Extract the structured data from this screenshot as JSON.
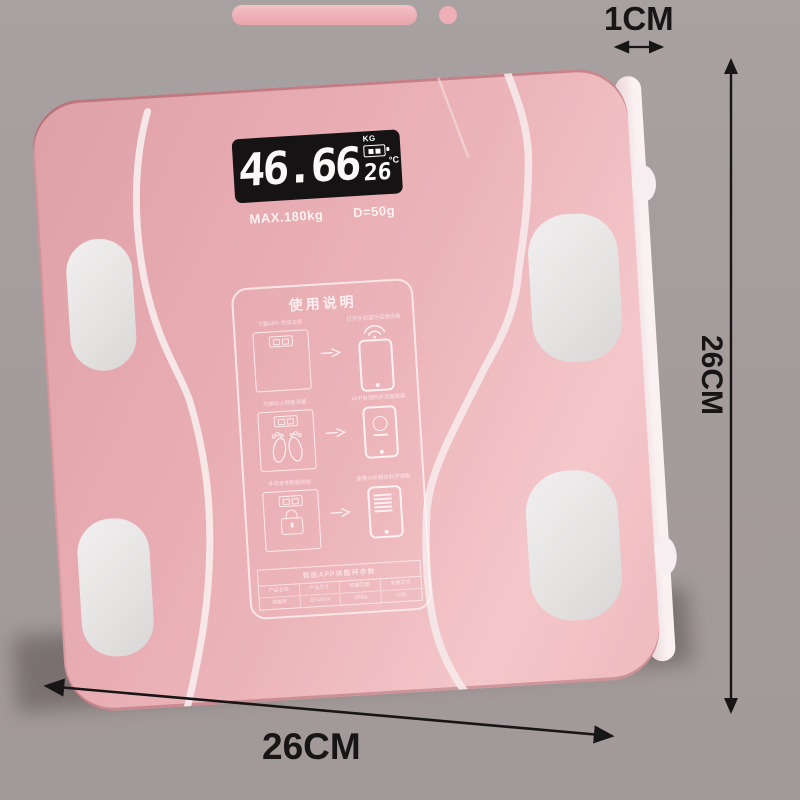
{
  "meta": {
    "background_color": "#a49b9b",
    "scale_pink": "#e9b0b5",
    "pad_color": "#e6e3e3",
    "ink_color": "#171515"
  },
  "dimensions": {
    "thickness_label": "1CM",
    "height_label": "26CM",
    "width_label": "26CM"
  },
  "scale": {
    "display": {
      "weight": "46.66",
      "weight_unit": "KG",
      "temperature": "26",
      "temperature_unit": "°C"
    },
    "specs": {
      "max_capacity": "MAX.180kg",
      "division": "D=50g"
    },
    "instructions": {
      "title": "使用说明",
      "steps": [
        {
          "left_caption": "下载APP·完成注册",
          "right_caption": "打开手机蓝牙连接设备"
        },
        {
          "left_caption": "光脚站上秤面测量",
          "right_caption": "APP自动同步测量数据"
        },
        {
          "left_caption": "多项身体数据指标",
          "right_caption": "查看分析报告科学减脂"
        }
      ],
      "table": {
        "header": "智能APP体脂秤参数",
        "columns": [
          "产品名称",
          "产品尺寸",
          "称重范围",
          "充电方式"
        ],
        "values": [
          "体脂秤",
          "26×26cm",
          "180kg",
          "USB"
        ]
      }
    }
  }
}
